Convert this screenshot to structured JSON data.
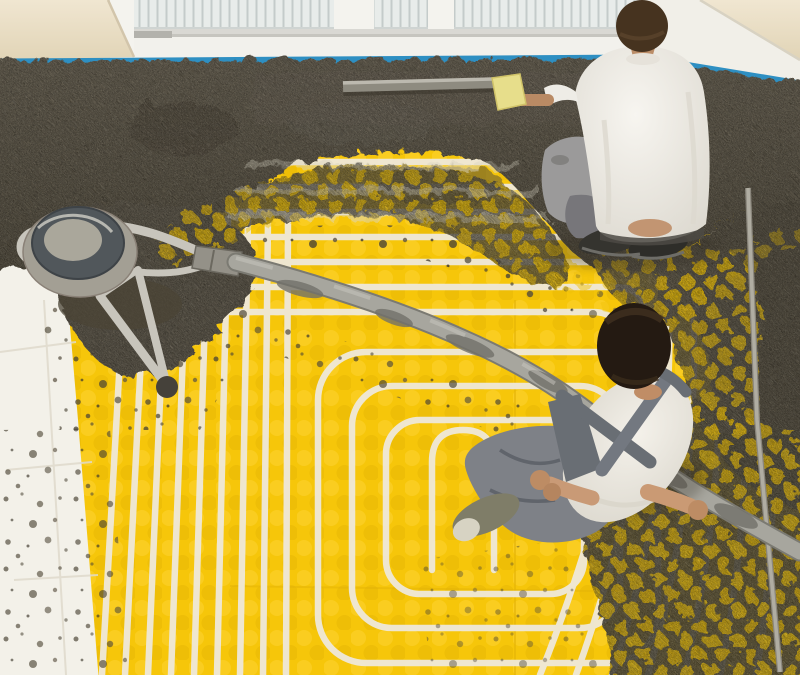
{
  "meta": {
    "type": "photograph",
    "title": "Underfloor heating installation",
    "alt": "Overhead view of two workers installing underfloor heating: wet gray screed is spread along the window wall over bright yellow studded panels laced with white heating pipes laid in a serpentine pattern; a screed pump drum with a long gray delivery hose crosses the floor; blue perimeter tape lines the base of the white windows; white insulation boards show at the lower left."
  },
  "scene": {
    "setting": "room interior, top-down view",
    "objects": [
      {
        "id": "window",
        "label": "window with blinds and white sill"
      },
      {
        "id": "wall",
        "label": "cream wall"
      },
      {
        "id": "edge-tape",
        "label": "blue perimeter edge tape",
        "color": "#2e8fc2"
      },
      {
        "id": "screed",
        "label": "wet concrete screed",
        "color": "#5e5748"
      },
      {
        "id": "panel",
        "label": "yellow studded floor-heating panel",
        "color": "#f6c60a"
      },
      {
        "id": "pipes",
        "label": "white heating pipes, serpentine loops",
        "color": "#efe8d6"
      },
      {
        "id": "insulation",
        "label": "white insulation boards",
        "color": "#f3f1e9"
      },
      {
        "id": "pump",
        "label": "screed pump drum with metal frame",
        "color": "#a39f94"
      },
      {
        "id": "hose",
        "label": "concrete delivery hose",
        "color": "#a7a69e"
      },
      {
        "id": "straightedge",
        "label": "screeding straightedge bar",
        "color": "#8e8b80"
      },
      {
        "id": "rod",
        "label": "thin metal rod on floor",
        "color": "#b0ada2"
      },
      {
        "id": "worker-top",
        "label": "kneeling worker in white t-shirt smoothing screed with a yellow float"
      },
      {
        "id": "worker-bottom",
        "label": "crouching worker in white t-shirt and gray overalls guiding the hose"
      }
    ]
  },
  "palette": {
    "wall": "#ece1c9",
    "window_frame": "#f4f3ee",
    "glass": "#e8ecea",
    "blind_slat": "#c4cbca",
    "tape_blue": "#2e8fc2",
    "concrete_dark": "#554e3f",
    "concrete_light": "#6a6252",
    "panel_yellow": "#f6c60a",
    "stud_highlight": "#ffd63c",
    "stud_shadow": "#e3b303",
    "pipe_white": "#efe8d6",
    "insulation_white": "#f3f1e9",
    "hose_gray": "#a7a69e",
    "skin": "#c2936e",
    "hair_dark": "#241a12",
    "hair_brown": "#46331f",
    "shirt_white": "#f3f0e9",
    "overall_gray": "#696e74",
    "pants_gray": "#7e8187",
    "float_yellow": "#e7de8b"
  }
}
